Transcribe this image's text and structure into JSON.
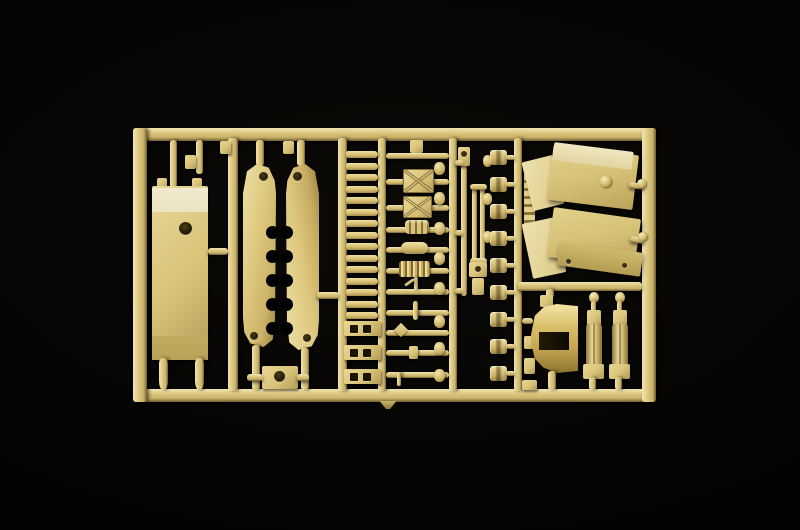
{
  "meta": {
    "title": "Photograph of a tan plastic model-kit sprue (injection-molded parts tree) on a black studio background",
    "object": "model-kit-sprue",
    "plastic_color_name": "sand tan"
  },
  "palette": {
    "bg": "#000000",
    "tan_hi": "#f1e5b2",
    "tan": "#d9c379",
    "tan_mid": "#c9b26a",
    "tan_edge": "#6f5d2f",
    "cream": "#ece3c2",
    "olive": "#b7a257",
    "hole_dark": "#1a1405"
  },
  "scene": {
    "width": 800,
    "height": 530,
    "parts": [
      {
        "name": "frame-top-runner",
        "cls": "bar-h",
        "x": 133,
        "y": 128,
        "w": 523,
        "h": 13
      },
      {
        "name": "frame-bottom-runner",
        "cls": "bar-h",
        "x": 133,
        "y": 389,
        "w": 523,
        "h": 13
      },
      {
        "name": "frame-left-runner",
        "cls": "bar-v",
        "x": 133,
        "y": 128,
        "w": 14,
        "h": 274
      },
      {
        "name": "frame-right-runner",
        "cls": "bar-v",
        "x": 642,
        "y": 128,
        "w": 14,
        "h": 274
      },
      {
        "name": "runner-a",
        "cls": "bar-v",
        "x": 228,
        "y": 138,
        "w": 10,
        "h": 253
      },
      {
        "name": "runner-b",
        "cls": "bar-v",
        "x": 338,
        "y": 138,
        "w": 9,
        "h": 253
      },
      {
        "name": "runner-c",
        "cls": "bar-v",
        "x": 378,
        "y": 138,
        "w": 8,
        "h": 253
      },
      {
        "name": "runner-d",
        "cls": "bar-v",
        "x": 449,
        "y": 138,
        "w": 8,
        "h": 253
      },
      {
        "name": "runner-e",
        "cls": "bar-v",
        "x": 514,
        "y": 138,
        "w": 8,
        "h": 253
      },
      {
        "name": "runner-divider",
        "cls": "bar-h",
        "x": 518,
        "y": 282,
        "w": 124,
        "h": 9
      },
      {
        "name": "sprue-gate-tab",
        "cls": "tab-tri",
        "x": 378,
        "y": 401,
        "w": 20,
        "h": 8
      },
      {
        "name": "plate-hanger-a",
        "cls": "stub",
        "x": 170,
        "y": 140,
        "w": 7,
        "h": 48
      },
      {
        "name": "plate-hanger-b",
        "cls": "stub",
        "x": 196,
        "y": 140,
        "w": 7,
        "h": 34
      },
      {
        "name": "plate-hanger-tab",
        "cls": "rect",
        "x": 185,
        "y": 155,
        "w": 11,
        "h": 14
      },
      {
        "name": "plate-top-peg-a",
        "cls": "rect",
        "x": 157,
        "y": 178,
        "w": 10,
        "h": 10
      },
      {
        "name": "plate-top-peg-b",
        "cls": "rect",
        "x": 192,
        "y": 178,
        "w": 10,
        "h": 10
      },
      {
        "name": "hull-plate",
        "cls": "rect",
        "x": 152,
        "y": 186,
        "w": 56,
        "h": 174
      },
      {
        "name": "hull-plate-cream-band",
        "cls": "cream",
        "x": 152,
        "y": 188,
        "w": 56,
        "h": 24
      },
      {
        "name": "hull-plate-hole",
        "cls": "hole",
        "x": 179,
        "y": 222,
        "w": 13,
        "h": 13
      },
      {
        "name": "hull-plate-olive-band",
        "cls": "olive",
        "x": 152,
        "y": 336,
        "w": 56,
        "h": 24
      },
      {
        "name": "hull-plate-peg-a",
        "cls": "peg",
        "x": 159,
        "y": 358,
        "w": 9,
        "h": 32
      },
      {
        "name": "hull-plate-peg-b",
        "cls": "peg",
        "x": 195,
        "y": 358,
        "w": 9,
        "h": 32
      },
      {
        "name": "plate-side-stub",
        "cls": "stub-h",
        "x": 208,
        "y": 248,
        "w": 20,
        "h": 7
      },
      {
        "name": "hang-tab-a",
        "cls": "rect",
        "x": 220,
        "y": 141,
        "w": 11,
        "h": 13
      },
      {
        "name": "hang-tab-b",
        "cls": "rect",
        "x": 283,
        "y": 141,
        "w": 11,
        "h": 13
      },
      {
        "name": "skirt-left-stub-top",
        "cls": "stub",
        "x": 256,
        "y": 140,
        "w": 8,
        "h": 26
      },
      {
        "name": "skirt-right-stub-top",
        "cls": "stub",
        "x": 297,
        "y": 140,
        "w": 8,
        "h": 26
      },
      {
        "name": "side-skirt-left",
        "cls": "blade-l",
        "x": 243,
        "y": 164,
        "w": 33,
        "h": 183
      },
      {
        "name": "side-skirt-right",
        "cls": "blade-r",
        "x": 286,
        "y": 164,
        "w": 33,
        "h": 186
      },
      {
        "name": "skirt-left-notch",
        "cls": "notch",
        "x": 266,
        "y": 226,
        "w": 13,
        "h": 13,
        "rep": {
          "n": 5,
          "dy": 24
        }
      },
      {
        "name": "skirt-right-notch",
        "cls": "notch",
        "x": 280,
        "y": 226,
        "w": 13,
        "h": 13,
        "rep": {
          "n": 5,
          "dy": 24
        }
      },
      {
        "name": "skirt-left-hole-top",
        "cls": "hole",
        "x": 259,
        "y": 172,
        "w": 9,
        "h": 9
      },
      {
        "name": "skirt-left-hole-bottom",
        "cls": "hole",
        "x": 250,
        "y": 332,
        "w": 8,
        "h": 8
      },
      {
        "name": "skirt-right-hole-top",
        "cls": "hole",
        "x": 293,
        "y": 172,
        "w": 9,
        "h": 9
      },
      {
        "name": "skirt-right-hole-bottom",
        "cls": "hole",
        "x": 303,
        "y": 334,
        "w": 8,
        "h": 8
      },
      {
        "name": "skirt-left-stub-bottom",
        "cls": "stub",
        "x": 252,
        "y": 345,
        "w": 8,
        "h": 45
      },
      {
        "name": "skirt-right-stub-bottom",
        "cls": "stub",
        "x": 301,
        "y": 348,
        "w": 8,
        "h": 42
      },
      {
        "name": "skirt-right-side-stub",
        "cls": "stub-h",
        "x": 317,
        "y": 292,
        "w": 22,
        "h": 7
      },
      {
        "name": "bracket-part",
        "cls": "rect",
        "x": 262,
        "y": 366,
        "w": 36,
        "h": 23
      },
      {
        "name": "bracket-part-hole",
        "cls": "hole",
        "x": 274,
        "y": 371,
        "w": 11,
        "h": 11
      },
      {
        "name": "bracket-arm-left",
        "cls": "stub-h",
        "x": 247,
        "y": 374,
        "w": 16,
        "h": 7
      },
      {
        "name": "bracket-arm-right",
        "cls": "stub-h",
        "x": 297,
        "y": 374,
        "w": 12,
        "h": 7
      },
      {
        "name": "track-rung",
        "cls": "rung",
        "x": 346,
        "y": 151,
        "w": 32,
        "h": 7,
        "rep": {
          "n": 15,
          "dy": 11.5
        }
      },
      {
        "name": "track-rung-holed",
        "cls": "rect",
        "x": 344,
        "y": 321,
        "w": 37,
        "h": 15,
        "rep": {
          "n": 3,
          "dy": 24
        }
      },
      {
        "name": "rung-hole-left",
        "cls": "dark-sq",
        "x": 350,
        "y": 325,
        "w": 8,
        "h": 8,
        "rep": {
          "n": 3,
          "dy": 24
        }
      },
      {
        "name": "rung-hole-right",
        "cls": "dark-sq",
        "x": 363,
        "y": 325,
        "w": 8,
        "h": 8,
        "rep": {
          "n": 3,
          "dy": 24
        }
      },
      {
        "name": "mid-hang-tab",
        "cls": "rect",
        "x": 410,
        "y": 140,
        "w": 13,
        "h": 13
      },
      {
        "name": "part-rod-0",
        "cls": "rod-h",
        "x": 386,
        "y": 153,
        "w": 63,
        "h": 6
      },
      {
        "name": "part-rod-1",
        "cls": "rod-h",
        "x": 386,
        "y": 179,
        "w": 63,
        "h": 6
      },
      {
        "name": "stowage-box-a",
        "cls": "xbox",
        "x": 403,
        "y": 169,
        "w": 29,
        "h": 22
      },
      {
        "name": "part-rod-2",
        "cls": "rod-h",
        "x": 386,
        "y": 205,
        "w": 63,
        "h": 6
      },
      {
        "name": "stowage-box-b",
        "cls": "xbox",
        "x": 403,
        "y": 196,
        "w": 27,
        "h": 20
      },
      {
        "name": "part-rod-3",
        "cls": "rod-h",
        "x": 386,
        "y": 227,
        "w": 63,
        "h": 6
      },
      {
        "name": "ringed-cylinder",
        "cls": "banded",
        "x": 405,
        "y": 220,
        "w": 24,
        "h": 14
      },
      {
        "name": "part-rod-4",
        "cls": "rod-h",
        "x": 386,
        "y": 247,
        "w": 63,
        "h": 6
      },
      {
        "name": "capsule-part",
        "cls": "capsule",
        "x": 401,
        "y": 242,
        "w": 27,
        "h": 12
      },
      {
        "name": "part-rod-5",
        "cls": "rod-h",
        "x": 386,
        "y": 268,
        "w": 63,
        "h": 6
      },
      {
        "name": "corrugated-part",
        "cls": "ribbed",
        "x": 399,
        "y": 261,
        "w": 31,
        "h": 16
      },
      {
        "name": "part-rod-6",
        "cls": "rod-h",
        "x": 386,
        "y": 289,
        "w": 63,
        "h": 6
      },
      {
        "name": "prong-up",
        "cls": "stub",
        "x": 414,
        "y": 277,
        "w": 4,
        "h": 13
      },
      {
        "name": "prong-tick",
        "cls": "stub-h",
        "x": 404,
        "y": 281,
        "w": 11,
        "h": 3,
        "r": -35
      },
      {
        "name": "part-rod-7",
        "cls": "rod-h",
        "x": 386,
        "y": 310,
        "w": 63,
        "h": 6
      },
      {
        "name": "cross-fitting",
        "cls": "stub",
        "x": 413,
        "y": 301,
        "w": 5,
        "h": 19
      },
      {
        "name": "part-rod-8",
        "cls": "rod-h",
        "x": 386,
        "y": 330,
        "w": 63,
        "h": 6
      },
      {
        "name": "diamond-fitting",
        "cls": "diamond",
        "x": 396,
        "y": 325,
        "w": 10,
        "h": 10,
        "r": 45
      },
      {
        "name": "part-rod-9",
        "cls": "rod-h",
        "x": 386,
        "y": 350,
        "w": 63,
        "h": 6
      },
      {
        "name": "rod-collar",
        "cls": "rect",
        "x": 409,
        "y": 346,
        "w": 9,
        "h": 13
      },
      {
        "name": "part-rod-10",
        "cls": "rod-h",
        "x": 386,
        "y": 372,
        "w": 63,
        "h": 6
      },
      {
        "name": "prong-down",
        "cls": "stub",
        "x": 397,
        "y": 372,
        "w": 4,
        "h": 14
      },
      {
        "name": "side-knob",
        "cls": "knob",
        "x": 434,
        "y": 162,
        "w": 11,
        "h": 13,
        "rep": {
          "n": 5,
          "dy": 30
        }
      },
      {
        "name": "side-knob-low",
        "cls": "knob",
        "x": 434,
        "y": 315,
        "w": 11,
        "h": 13,
        "rep": {
          "n": 3,
          "dy": 27
        }
      },
      {
        "name": "barrel-rod",
        "cls": "rod-v",
        "x": 461,
        "y": 150,
        "w": 6,
        "h": 146
      },
      {
        "name": "barrel-top-tab",
        "cls": "rect",
        "x": 458,
        "y": 147,
        "w": 12,
        "h": 19
      },
      {
        "name": "barrel-tab-hole",
        "cls": "hole",
        "x": 461,
        "y": 151,
        "w": 6,
        "h": 6
      },
      {
        "name": "cradle-rail-a",
        "cls": "rod-v",
        "x": 472,
        "y": 188,
        "w": 5,
        "h": 78
      },
      {
        "name": "cradle-rail-b",
        "cls": "rod-v",
        "x": 480,
        "y": 188,
        "w": 5,
        "h": 78
      },
      {
        "name": "cradle-cross-top",
        "cls": "stub-h",
        "x": 470,
        "y": 184,
        "w": 17,
        "h": 6
      },
      {
        "name": "cradle-cross-bottom",
        "cls": "stub-h",
        "x": 470,
        "y": 258,
        "w": 17,
        "h": 6
      },
      {
        "name": "cradle-block",
        "cls": "rect",
        "x": 469,
        "y": 262,
        "w": 18,
        "h": 15
      },
      {
        "name": "cradle-block-hole",
        "cls": "hole",
        "x": 475,
        "y": 266,
        "w": 6,
        "h": 6
      },
      {
        "name": "barrel-end-block",
        "cls": "rect",
        "x": 472,
        "y": 278,
        "w": 12,
        "h": 17
      },
      {
        "name": "rod-stub-a",
        "cls": "stub-h",
        "x": 455,
        "y": 160,
        "w": 8,
        "h": 6
      },
      {
        "name": "rod-stub-b",
        "cls": "stub-h",
        "x": 455,
        "y": 230,
        "w": 8,
        "h": 6
      },
      {
        "name": "rod-stub-c",
        "cls": "stub-h",
        "x": 455,
        "y": 288,
        "w": 8,
        "h": 6
      },
      {
        "name": "rod-knob",
        "cls": "knob",
        "x": 483,
        "y": 155,
        "w": 9,
        "h": 12,
        "rep": {
          "n": 3,
          "dy": 38
        }
      },
      {
        "name": "clip-part",
        "cls": "clip",
        "x": 490,
        "y": 150,
        "w": 17,
        "h": 15,
        "rep": {
          "n": 9,
          "dy": 27
        }
      },
      {
        "name": "clip-stub",
        "cls": "stub-h",
        "x": 506,
        "y": 155,
        "w": 9,
        "h": 5,
        "rep": {
          "n": 9,
          "dy": 27
        }
      },
      {
        "name": "small-part-a",
        "cls": "rect",
        "x": 524,
        "y": 336,
        "w": 11,
        "h": 13
      },
      {
        "name": "small-part-b",
        "cls": "rect",
        "x": 524,
        "y": 358,
        "w": 11,
        "h": 16
      },
      {
        "name": "small-part-c",
        "cls": "rect",
        "x": 522,
        "y": 380,
        "w": 15,
        "h": 10
      },
      {
        "name": "ridge-bracket",
        "cls": "ridged-v",
        "x": 524,
        "y": 172,
        "w": 11,
        "h": 56
      },
      {
        "name": "fender-top-facet",
        "cls": "facet",
        "x": 527,
        "y": 158,
        "w": 32,
        "h": 50,
        "r": -14
      },
      {
        "name": "fender-top-main",
        "cls": "panel",
        "x": 550,
        "y": 150,
        "w": 86,
        "h": 55,
        "r": 7
      },
      {
        "name": "fender-top-face",
        "cls": "panel-top",
        "x": 553,
        "y": 147,
        "w": 80,
        "h": 18,
        "r": 7
      },
      {
        "name": "fender-top-ball",
        "cls": "ball",
        "x": 600,
        "y": 176,
        "w": 11,
        "h": 11
      },
      {
        "name": "fender-top-peg",
        "cls": "stub-h",
        "x": 629,
        "y": 183,
        "w": 16,
        "h": 6,
        "r": 8
      },
      {
        "name": "fender-top-peg-ball",
        "cls": "ball",
        "x": 637,
        "y": 179,
        "w": 9,
        "h": 9
      },
      {
        "name": "fender-bottom-facet",
        "cls": "facet",
        "x": 527,
        "y": 220,
        "w": 34,
        "h": 56,
        "r": -12
      },
      {
        "name": "fender-bottom-main",
        "cls": "panel",
        "x": 550,
        "y": 213,
        "w": 88,
        "h": 50,
        "r": 8
      },
      {
        "name": "fender-bottom-ext",
        "cls": "panel-dark",
        "x": 558,
        "y": 247,
        "w": 84,
        "h": 24,
        "r": 8
      },
      {
        "name": "fender-bottom-peg",
        "cls": "stub-h",
        "x": 630,
        "y": 237,
        "w": 15,
        "h": 6,
        "r": 8
      },
      {
        "name": "fender-bottom-peg-ball",
        "cls": "ball",
        "x": 638,
        "y": 232,
        "w": 9,
        "h": 9
      },
      {
        "name": "fender-dot-a",
        "cls": "hole",
        "x": 566,
        "y": 259,
        "w": 5,
        "h": 5
      },
      {
        "name": "fender-dot-b",
        "cls": "hole",
        "x": 622,
        "y": 263,
        "w": 5,
        "h": 5
      },
      {
        "name": "cone-side-stub",
        "cls": "stub-h",
        "x": 522,
        "y": 318,
        "w": 11,
        "h": 6
      },
      {
        "name": "cone-top-stub",
        "cls": "stub",
        "x": 546,
        "y": 289,
        "w": 8,
        "h": 9
      },
      {
        "name": "cone-top-tab",
        "cls": "rect",
        "x": 540,
        "y": 295,
        "w": 13,
        "h": 12
      },
      {
        "name": "horn-cone",
        "cls": "cone",
        "x": 531,
        "y": 304,
        "w": 47,
        "h": 69
      },
      {
        "name": "horn-cone-notch",
        "cls": "cone-notch",
        "x": 539,
        "y": 332,
        "w": 30,
        "h": 18
      },
      {
        "name": "cone-bottom-stub",
        "cls": "stub",
        "x": 548,
        "y": 371,
        "w": 8,
        "h": 19
      },
      {
        "name": "shock-knob-a",
        "cls": "ball",
        "x": 589,
        "y": 292,
        "w": 10,
        "h": 11
      },
      {
        "name": "shock-stem-a",
        "cls": "stub",
        "x": 591,
        "y": 301,
        "w": 5,
        "h": 11
      },
      {
        "name": "shock-upper-a",
        "cls": "rect",
        "x": 587,
        "y": 310,
        "w": 14,
        "h": 16
      },
      {
        "name": "shock-body-a",
        "cls": "cyl",
        "x": 586,
        "y": 324,
        "w": 16,
        "h": 42
      },
      {
        "name": "shock-bracket-a",
        "cls": "rect",
        "x": 583,
        "y": 364,
        "w": 21,
        "h": 15
      },
      {
        "name": "shock-foot-a",
        "cls": "stub",
        "x": 589,
        "y": 377,
        "w": 7,
        "h": 13
      },
      {
        "name": "shock-knob-b",
        "cls": "ball",
        "x": 615,
        "y": 292,
        "w": 10,
        "h": 11
      },
      {
        "name": "shock-stem-b",
        "cls": "stub",
        "x": 617,
        "y": 301,
        "w": 5,
        "h": 11
      },
      {
        "name": "shock-upper-b",
        "cls": "rect",
        "x": 613,
        "y": 310,
        "w": 14,
        "h": 16
      },
      {
        "name": "shock-body-b",
        "cls": "cyl",
        "x": 612,
        "y": 324,
        "w": 16,
        "h": 42
      },
      {
        "name": "shock-bracket-b",
        "cls": "rect",
        "x": 609,
        "y": 364,
        "w": 21,
        "h": 15
      },
      {
        "name": "shock-foot-b",
        "cls": "stub",
        "x": 615,
        "y": 377,
        "w": 7,
        "h": 13
      }
    ]
  }
}
